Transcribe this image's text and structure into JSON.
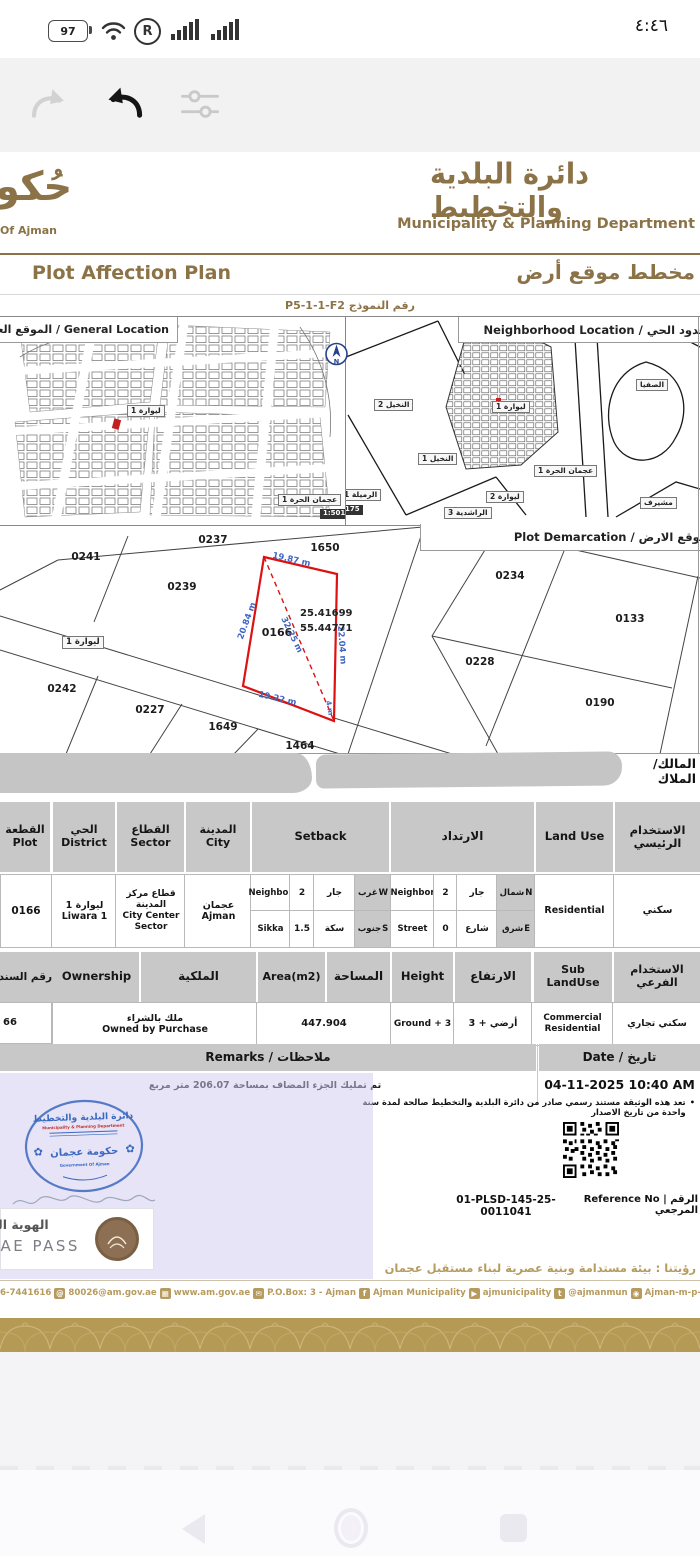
{
  "status_bar": {
    "battery_percent": "97",
    "time": "٤:٤٦"
  },
  "header": {
    "logo_calligraphy": "حُكومة",
    "logo_caption": "Of Ajman",
    "dept_name_ar": "دائرة البلدية والتخطيط",
    "dept_name_en": "Municipality & Planning Department"
  },
  "title": {
    "en": "Plot Affection Plan",
    "ar": "مخطط موقع أرض",
    "form_no": "رقم النموذج P5-1-1-F2"
  },
  "maps": {
    "general_location_label": "General Location / الموقع العام",
    "neighborhood_label": "Neighborhood Location / حدود الحي",
    "compass_letter": "N",
    "general_map": {
      "district_tag": "ليوارة 1",
      "freezone_tag": "عجمان الحرة 1",
      "scale_tag": "1:501"
    },
    "neighborhood_map": {
      "labels": [
        "النخيل 2",
        "النخيل 1",
        "الرميلة 1",
        "ليوارة 1",
        "ليوارة 2",
        "عجمان الحرة 1",
        "الراشدية 3",
        "مشيرف",
        "الصفيا"
      ],
      "scale_tag": "175"
    }
  },
  "demarcation": {
    "label": "Plot Demarcation / موقع الارض",
    "district_tag": "ليوارة 1",
    "numbers": [
      "0237",
      "1650",
      "0241",
      "0239",
      "0166",
      "0242",
      "0227",
      "1649",
      "1464",
      "0234",
      "0133",
      "0228",
      "0190"
    ],
    "dims": {
      "top": "19.87 m",
      "left": "20.84 m",
      "right": "22.04 m",
      "bottom": "19.22 m",
      "diagonal": "32.25 m",
      "corner": "4 m"
    },
    "coords_line1": "25.41699",
    "coords_line2": "55.44771"
  },
  "owner": {
    "label": "المالك/الملاك",
    "colon": ":"
  },
  "table1": {
    "headers": {
      "plot_ar": "القطعة",
      "plot_en": "Plot",
      "district_ar": "الحي",
      "district_en": "District",
      "sector_ar": "القطاع",
      "sector_en": "Sector",
      "city_ar": "المدينة",
      "city_en": "City",
      "setback": "Setback",
      "setback_ar": "الارتداد",
      "land_use": "Land Use",
      "main_use_ar": "الاستخدام الرئيسي"
    },
    "row": {
      "plot": "0166",
      "district_ar": "ليوارة 1",
      "district_en": "Liwara 1",
      "sector_ar": "قطاع مركز المدينة",
      "sector_en": "City Center Sector",
      "city_ar": "عجمان",
      "city_en": "Ajman",
      "setback_w": {
        "type_en": "Neighbor",
        "value": "2",
        "type_ar": "جار",
        "dir_ar": "غرب",
        "dir_en": "W"
      },
      "setback_s": {
        "type_en": "Sikka",
        "value": "1.5",
        "type_ar": "سكة",
        "dir_ar": "جنوب",
        "dir_en": "S"
      },
      "setback_n": {
        "type_en": "Neighbor",
        "value": "2",
        "type_ar": "جار",
        "dir_ar": "شمال",
        "dir_en": "N"
      },
      "setback_e": {
        "type_en": "Street",
        "value": "0",
        "type_ar": "شارع",
        "dir_ar": "شرق",
        "dir_en": "E"
      },
      "land_use": "Residential",
      "main_use_ar": "سكني"
    }
  },
  "table2": {
    "headers": {
      "deed_ar": "رقم السند",
      "ownership_en": "Ownership",
      "ownership_ar": "الملكية",
      "area_en": "Area(m2)",
      "area_ar": "المساحة",
      "height_en": "Height",
      "height_ar": "الارتفاع",
      "sub_use_en": "Sub LandUse",
      "sub_use_ar": "الاستخدام الفرعي"
    },
    "row": {
      "deed": "66",
      "ownership_ar": "ملك بالشراء",
      "ownership_en": "Owned by Purchase",
      "area": "447.904",
      "height_en": "Ground + 3",
      "height_ar": "أرضي + 3",
      "sub_use_en_1": "Commercial",
      "sub_use_en_2": "Residential",
      "sub_use_ar": "سكني تجاري"
    }
  },
  "remarks": {
    "header": "Remarks / ملاحظات",
    "date_header": "Date / تاريخ",
    "remark": "تم تمليك الجزء المضاف بمساحة 206.07 متر مربع",
    "date_value": "04-11-2025 10:40 AM",
    "bullet": "•",
    "note": "تعد هذه الوثيقة مستند رسمي صادر من دائرة البلدية والتخطيط صالحة لمدة سنة واحدة من تاريخ الاصدار"
  },
  "stamp": {
    "line1_ar": "دائرة البلدية والتخطيط",
    "line2_en": "Municipality & Planning Department",
    "line3_ar": "حكومة عجمان",
    "line4_en": "Government Of Ajman"
  },
  "uae_pass": {
    "title_ar": "الهوية الرقمية",
    "title_en": "UAE PASS"
  },
  "reference": {
    "value": "01-PLSD-145-25-0011041",
    "label": "Reference No | الرقم المرجعي"
  },
  "vision": "رؤيتنا : بيئة مستدامة وبنية عصرية لبناء مستقبل عجمان",
  "contacts": {
    "items": [
      "06-7441616",
      "80026@am.gov.ae",
      "www.am.gov.ae",
      "P.O.Box: 3 - Ajman",
      "Ajman Municipality",
      "ajmunicipality",
      "@ajmanmun",
      "Ajman-m-p-d"
    ],
    "icon_glyphs": {
      "at": "@",
      "fax": "▦",
      "mail": "✉",
      "facebook": "f",
      "youtube": "▶",
      "twitter": "t",
      "instagram": "◉"
    }
  }
}
